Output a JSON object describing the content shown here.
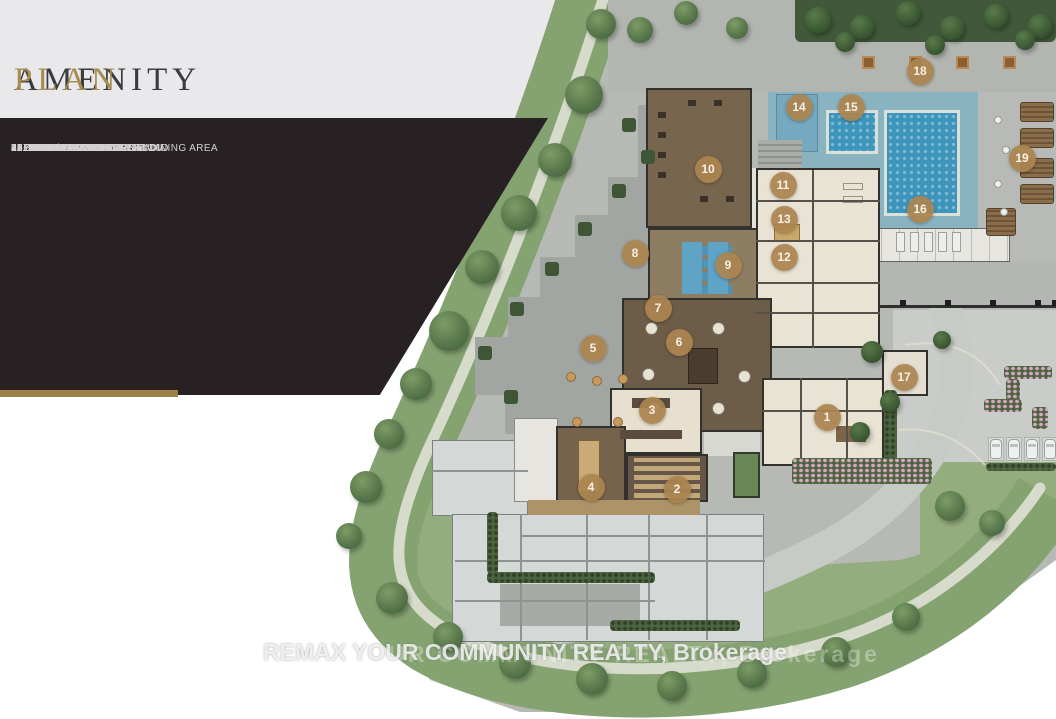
{
  "title": {
    "primary": "AMENITY",
    "secondary": "PLAN"
  },
  "legend": {
    "items": [
      {
        "num": "1",
        "label": "LOBBY"
      },
      {
        "num": "2",
        "label": "THEATRE ROOM"
      },
      {
        "num": "3",
        "label": "GOURMET KITCHEN"
      },
      {
        "num": "4",
        "label": "DINING ROOM"
      },
      {
        "num": "5",
        "label": "OUTDOOR DINING ROOM"
      },
      {
        "num": "6",
        "label": "PARTY ROOM"
      },
      {
        "num": "7",
        "label": "LOUNGE"
      },
      {
        "num": "8",
        "label": "OUTDOOR YOGA AREA"
      },
      {
        "num": "9",
        "label": "YOGA / WELLBEATS STUDIO"
      },
      {
        "num": "10",
        "label": "FITNESS CENTRE"
      },
      {
        "num": "11",
        "label": "MEN'S CHANGE ROOM"
      },
      {
        "num": "12",
        "label": "WOMEN'S CHANGE ROOM"
      },
      {
        "num": "13",
        "label": "SAUNA"
      },
      {
        "num": "14",
        "label": "STEAM ROOM"
      },
      {
        "num": "15",
        "label": "FLUSH EDGE HOT TUB"
      },
      {
        "num": "16",
        "label": "FLUSH EDGE POOL"
      },
      {
        "num": "17",
        "label": "DOG SPA"
      },
      {
        "num": "18",
        "label": "ALFRESCO KITCHEN & DINING AREA"
      },
      {
        "num": "19",
        "label": "OUTDOOR SUN DECK"
      }
    ]
  },
  "plan_markers": [
    {
      "num": "1",
      "x": 827,
      "y": 417
    },
    {
      "num": "2",
      "x": 677,
      "y": 489
    },
    {
      "num": "3",
      "x": 652,
      "y": 410
    },
    {
      "num": "4",
      "x": 591,
      "y": 487
    },
    {
      "num": "5",
      "x": 593,
      "y": 348
    },
    {
      "num": "6",
      "x": 679,
      "y": 342
    },
    {
      "num": "7",
      "x": 658,
      "y": 308
    },
    {
      "num": "8",
      "x": 635,
      "y": 253
    },
    {
      "num": "9",
      "x": 728,
      "y": 265
    },
    {
      "num": "10",
      "x": 708,
      "y": 169
    },
    {
      "num": "11",
      "x": 783,
      "y": 185
    },
    {
      "num": "12",
      "x": 784,
      "y": 257
    },
    {
      "num": "13",
      "x": 784,
      "y": 219
    },
    {
      "num": "14",
      "x": 799,
      "y": 107
    },
    {
      "num": "15",
      "x": 851,
      "y": 107
    },
    {
      "num": "16",
      "x": 920,
      "y": 209
    },
    {
      "num": "17",
      "x": 904,
      "y": 377
    },
    {
      "num": "18",
      "x": 920,
      "y": 71
    },
    {
      "num": "19",
      "x": 1022,
      "y": 158
    }
  ],
  "watermark": "REMAX YOUR COMMUNITY REALTY, Brokerage",
  "colors": {
    "accent_gold": "#a68e52",
    "panel_dark": "#272123",
    "marker_bronze": "#ab8450",
    "water_blue": "#3d95bb",
    "pool_deck": "#8ab3c2",
    "lawn_green": "#94ad7f",
    "band_green": "#85a371"
  }
}
